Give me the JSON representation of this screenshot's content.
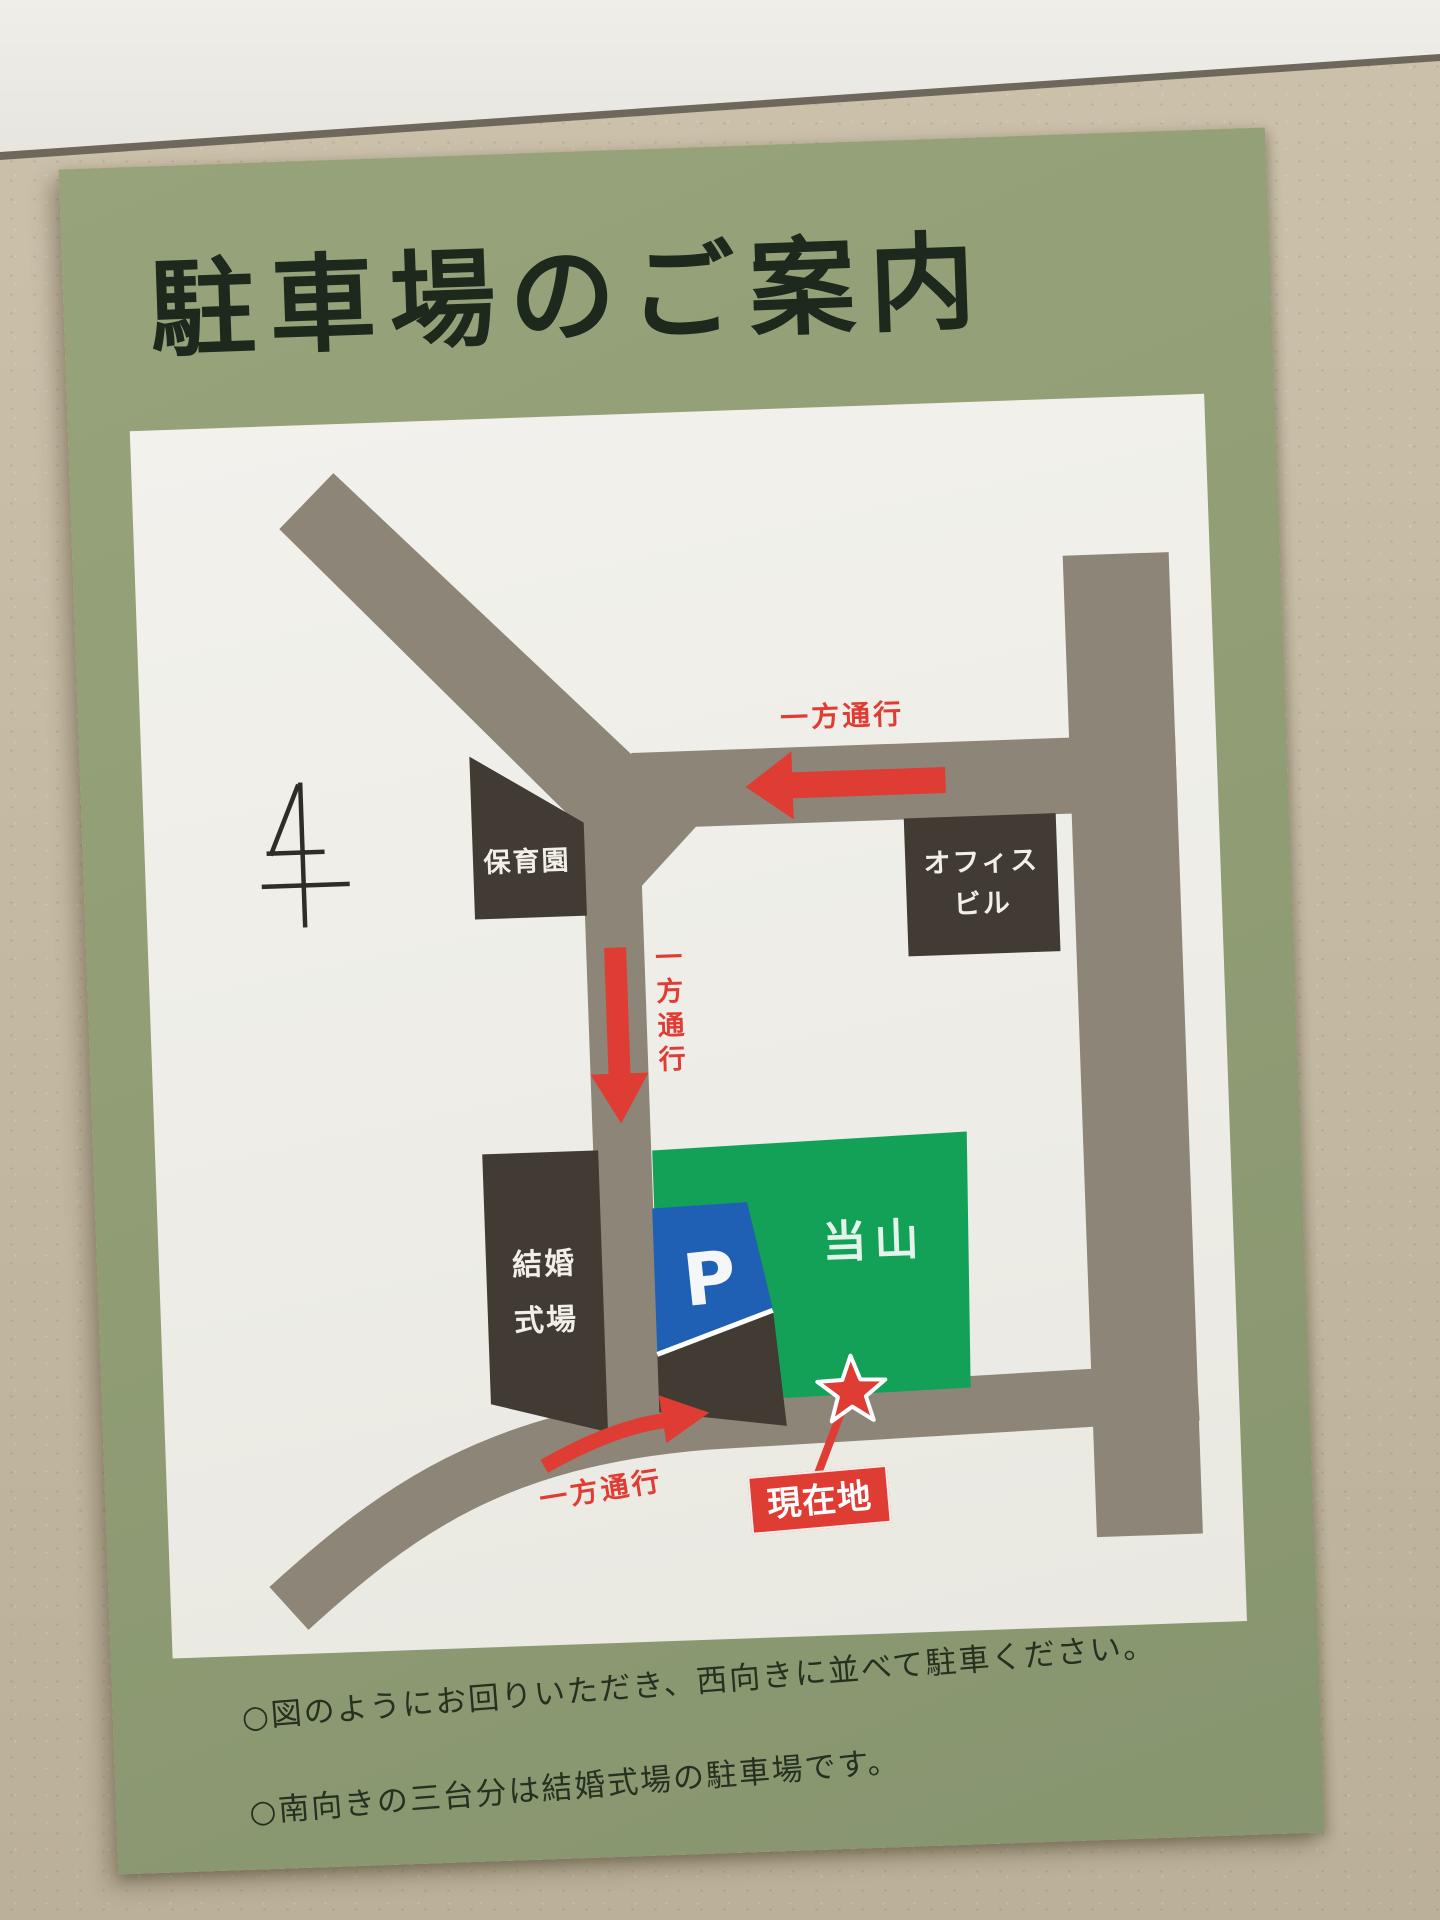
{
  "poster": {
    "title": "駐車場のご案内",
    "notes": [
      "○図のようにお回りいただき、西向きに並べて駐車ください。",
      "○南向きの三台分は結婚式場の駐車場です。"
    ]
  },
  "map": {
    "buildings": {
      "nursery": {
        "label": "保育園"
      },
      "office": {
        "line1": "オフィス",
        "line2": "ビル"
      },
      "wedding": {
        "line1": "結婚",
        "line2": "式場"
      }
    },
    "site": {
      "label": "当山"
    },
    "parking": {
      "label": "P"
    },
    "current_location": {
      "label": "現在地"
    },
    "one_way": {
      "top": "一方通行",
      "middle": "一方通行",
      "bottom": "一方通行"
    }
  },
  "colors": {
    "wall-beige": "#c8bda5",
    "poster-green": "#8f9c74",
    "map-white": "#f0efe9",
    "road": "#8d8678",
    "building": "#423b33",
    "site-green": "#13a057",
    "parking-blue": "#2060b4",
    "accent-red": "#df3c34",
    "title-ink": "#1c291c",
    "note-ink": "#25301f"
  }
}
